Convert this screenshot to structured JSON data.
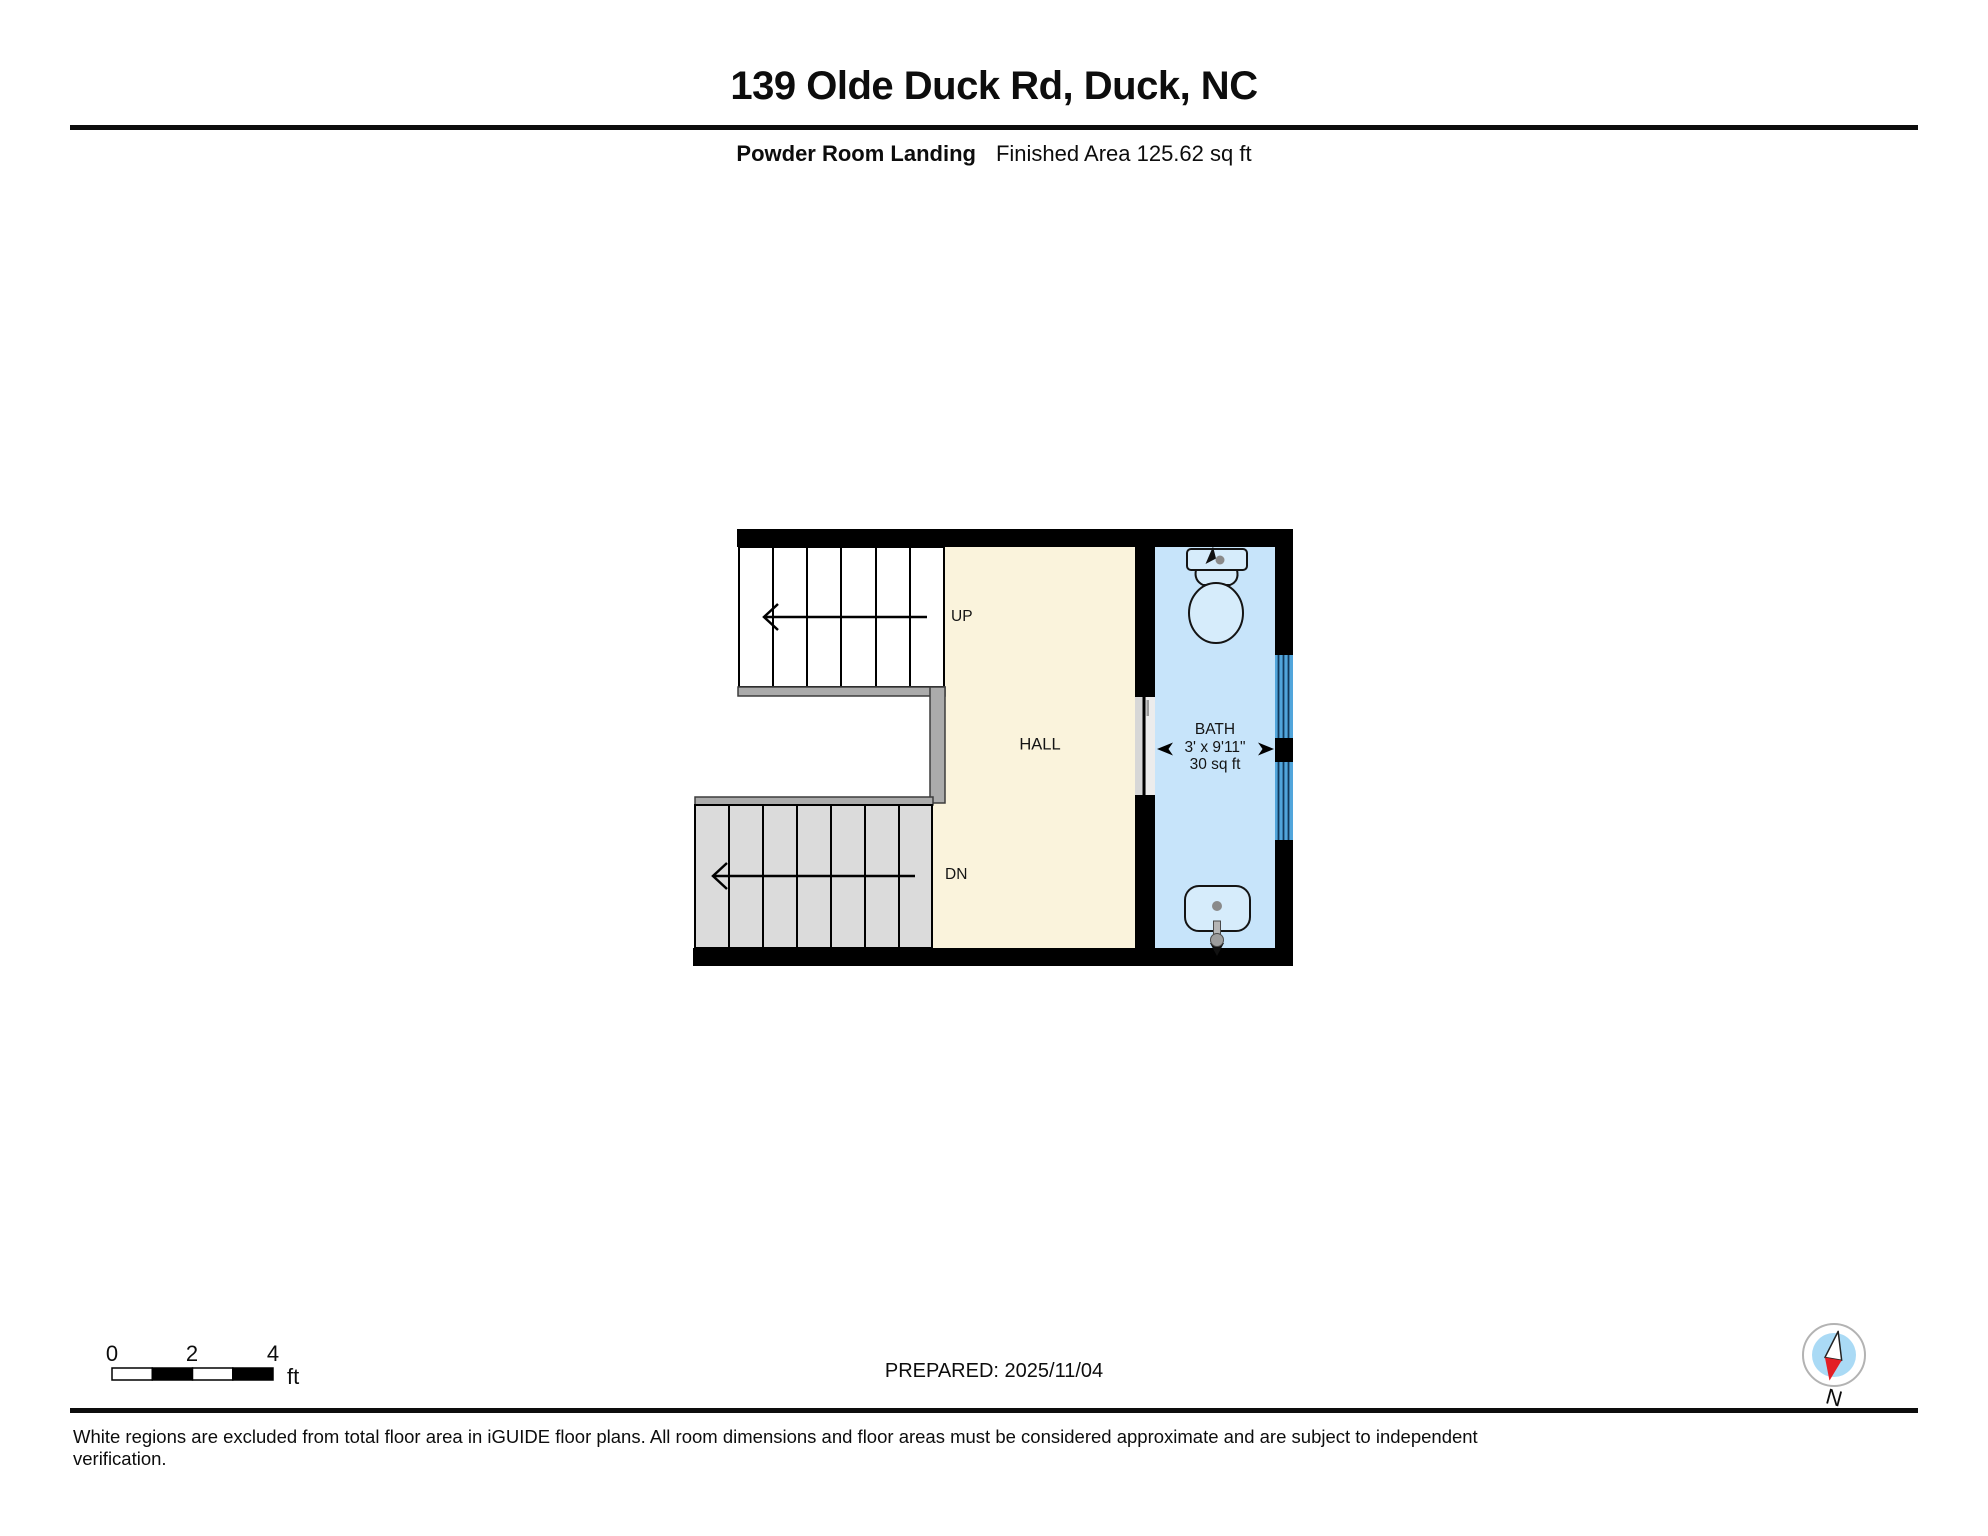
{
  "header": {
    "title": "139 Olde Duck Rd, Duck, NC",
    "floor_label": "Powder Room Landing",
    "area_label": "Finished Area 125.62 sq ft"
  },
  "plan": {
    "hall": {
      "label": "HALL"
    },
    "bath": {
      "label": "BATH",
      "dimensions": "3' x 9'11\"",
      "area": "30 sq ft"
    },
    "stairs": {
      "up": "UP",
      "down": "DN"
    }
  },
  "footer": {
    "scale": {
      "ticks": [
        "0",
        "2",
        "4"
      ],
      "unit": "ft"
    },
    "prepared": "PREPARED: 2025/11/04",
    "compass": "N",
    "disclaimer": "White regions are excluded from total floor area in iGUIDE floor plans. All room dimensions and floor areas must be considered approximate and are subject to independent verification."
  },
  "colors": {
    "wall": "#000000",
    "hall-fill": "#FAF3DC",
    "bath-fill": "#C7E4FA",
    "fixture-fill": "#D6ECFB",
    "window-fill": "#51A5DB",
    "window-line": "#12395C",
    "stair-fill": "#DBDBDB",
    "railing-fill": "#ABABAB",
    "railing-line": "#3D3D3D",
    "compass-blue": "#AADAF5",
    "compass-red": "#E31E24"
  }
}
